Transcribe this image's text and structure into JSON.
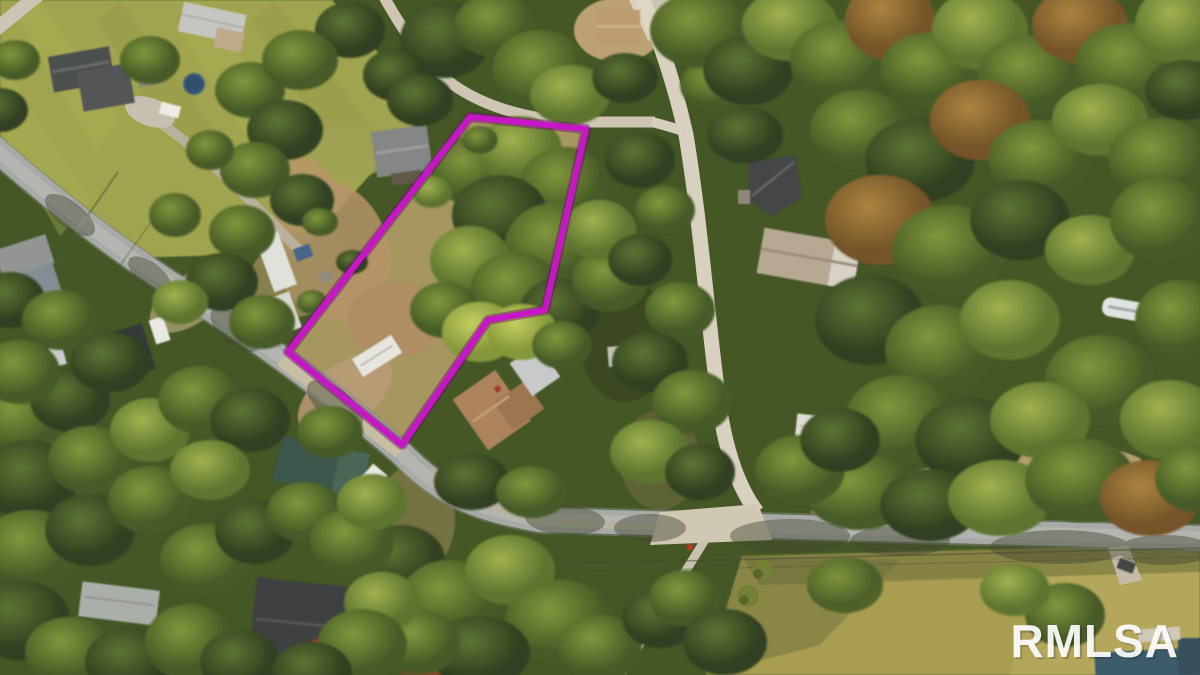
{
  "photo": {
    "type": "aerial-drone-photo",
    "subject": "wooded rural residential land with roads and a highlighted lot"
  },
  "watermark": {
    "text": "RMLSA",
    "color": "#ffffff",
    "opacity": "0.92",
    "position": "bottom-right",
    "font_size": "46"
  },
  "boundary": {
    "color": "#c617c6",
    "halo_color": "#6d0a6d",
    "stroke_width": "6",
    "points": "470,117 586,129 545,310 488,320 402,445 288,352"
  },
  "palette": {
    "forest_base": "#3a511f",
    "canopy_dark": "#2e421c",
    "canopy_mid": "#5d7a2c",
    "canopy_light": "#9cb24a",
    "canopy_autumn": "#96692f",
    "lawn": "#9ba24b",
    "dry_field": "#a59a4f",
    "dirt": "#b39066",
    "paved_road": "#a4a8a8",
    "gravel_road": "#d7d1c2"
  },
  "features": {
    "roads": [
      "paved-road",
      "gravel-road",
      "top-lane",
      "south-path",
      "northeast-driveway"
    ],
    "buildings": [
      "house-top-left",
      "shed-top-left",
      "mobile-home-top",
      "house-left",
      "carport-left",
      "house-center-nw",
      "tan-house-top",
      "gable-house-right",
      "barn-right",
      "trailer-right",
      "rv-on-lot",
      "brown-house-center",
      "carport-center",
      "green-building",
      "house-bottom-left",
      "mobile-home-bottom-left",
      "rusty-building"
    ],
    "vehicles": [
      "white-truck-road",
      "red-car",
      "white-car-left",
      "silver-car-left",
      "boat-right",
      "campers-row"
    ]
  }
}
